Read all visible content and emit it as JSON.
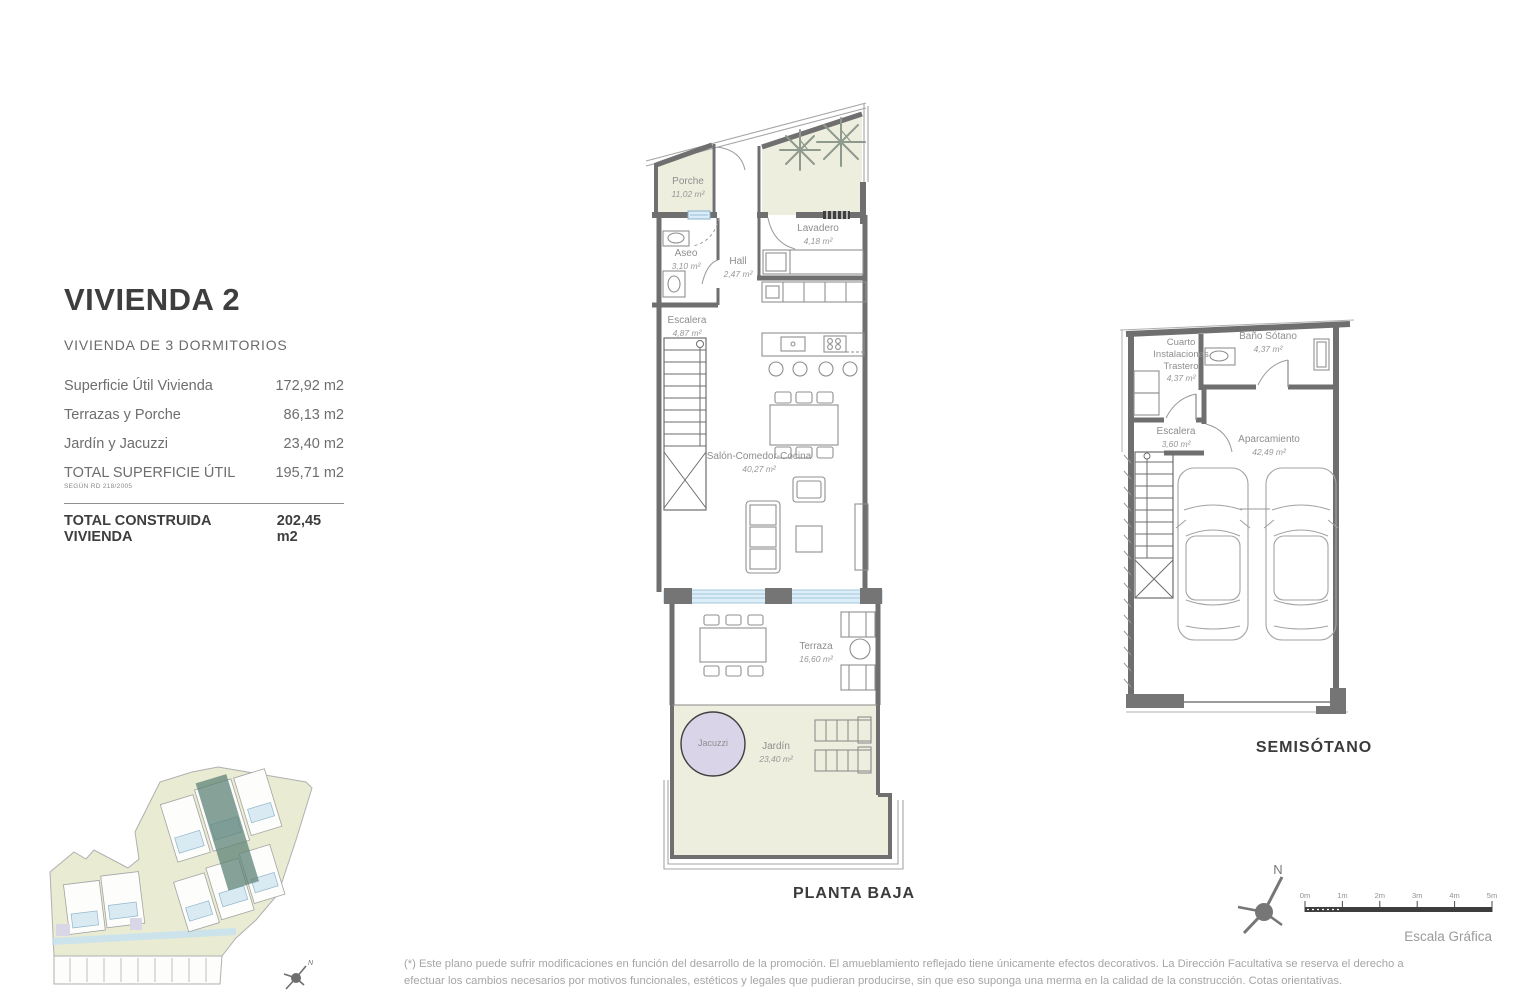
{
  "info_panel": {
    "title": "VIVIENDA 2",
    "subtitle": "VIVIENDA DE 3 DORMITORIOS",
    "rows": [
      {
        "label": "Superficie Útil Vivienda",
        "value": "172,92 m2"
      },
      {
        "label": "Terrazas y Porche",
        "value": "86,13 m2"
      },
      {
        "label": "Jardín y Jacuzzi",
        "value": "23,40 m2"
      },
      {
        "label": "TOTAL SUPERFICIE ÚTIL",
        "note": "SEGÚN RD 218/2005",
        "value": "195,71 m2"
      }
    ],
    "total": {
      "label": "TOTAL CONSTRUIDA VIVIENDA",
      "value": "202,45 m2"
    }
  },
  "planta_baja": {
    "caption": "PLANTA BAJA",
    "rooms": {
      "porche": {
        "name": "Porche",
        "area": "11,02 m²"
      },
      "aseo": {
        "name": "Aseo",
        "area": "3,10 m²"
      },
      "hall": {
        "name": "Hall",
        "area": "2,47 m²"
      },
      "lavadero": {
        "name": "Lavadero",
        "area": "4,18 m²"
      },
      "escalera": {
        "name": "Escalera",
        "area": "4,87 m²"
      },
      "salon": {
        "name": "Salón-Comedor-Cocina",
        "area": "40,27 m²"
      },
      "terraza": {
        "name": "Terraza",
        "area": "16,60 m²"
      },
      "jacuzzi": {
        "name": "Jacuzzi"
      },
      "jardin": {
        "name": "Jardín",
        "area": "23,40 m²"
      }
    }
  },
  "semisotano": {
    "caption": "SEMISÓTANO",
    "rooms": {
      "cuarto_instalaciones": {
        "name": "Cuarto Instalaciones Trastero",
        "area": "4,37 m²"
      },
      "bano_sotano": {
        "name": "Baño Sótano",
        "area": "4,37 m²"
      },
      "escalera": {
        "name": "Escalera",
        "area": "3,60 m²"
      },
      "aparcamiento": {
        "name": "Aparcamiento",
        "area": "42,49 m²"
      }
    }
  },
  "compass": {
    "label": "N"
  },
  "site_compass": {
    "label": "N"
  },
  "scale_bar": {
    "ticks": [
      "0m",
      "1m",
      "2m",
      "3m",
      "4m",
      "5m"
    ],
    "caption": "Escala Gráfica"
  },
  "footnote": {
    "line1": "(*) Este plano puede sufrir modificaciones en función del desarrollo de la promoción. El amueblamiento reflejado tiene únicamente efectos decorativos. La Dirección Facultativa se reserva el derecho a",
    "line2": "efectuar los cambios necesarios por motivos funcionales, estéticos y legales que pudieran producirse, sin que eso suponga una merma en la calidad de la construcción. Cotas orientativas."
  },
  "colors": {
    "wall_gray": "#6f6f6f",
    "outdoor_beige": "#eeeedf",
    "glass_blue": "#ddeef8",
    "jacuzzi_lavender": "#d9d4e8",
    "site_highlight_teal": "#5d8377",
    "site_green": "#e9ebd3",
    "site_pool_blue": "#d9eaf3"
  }
}
